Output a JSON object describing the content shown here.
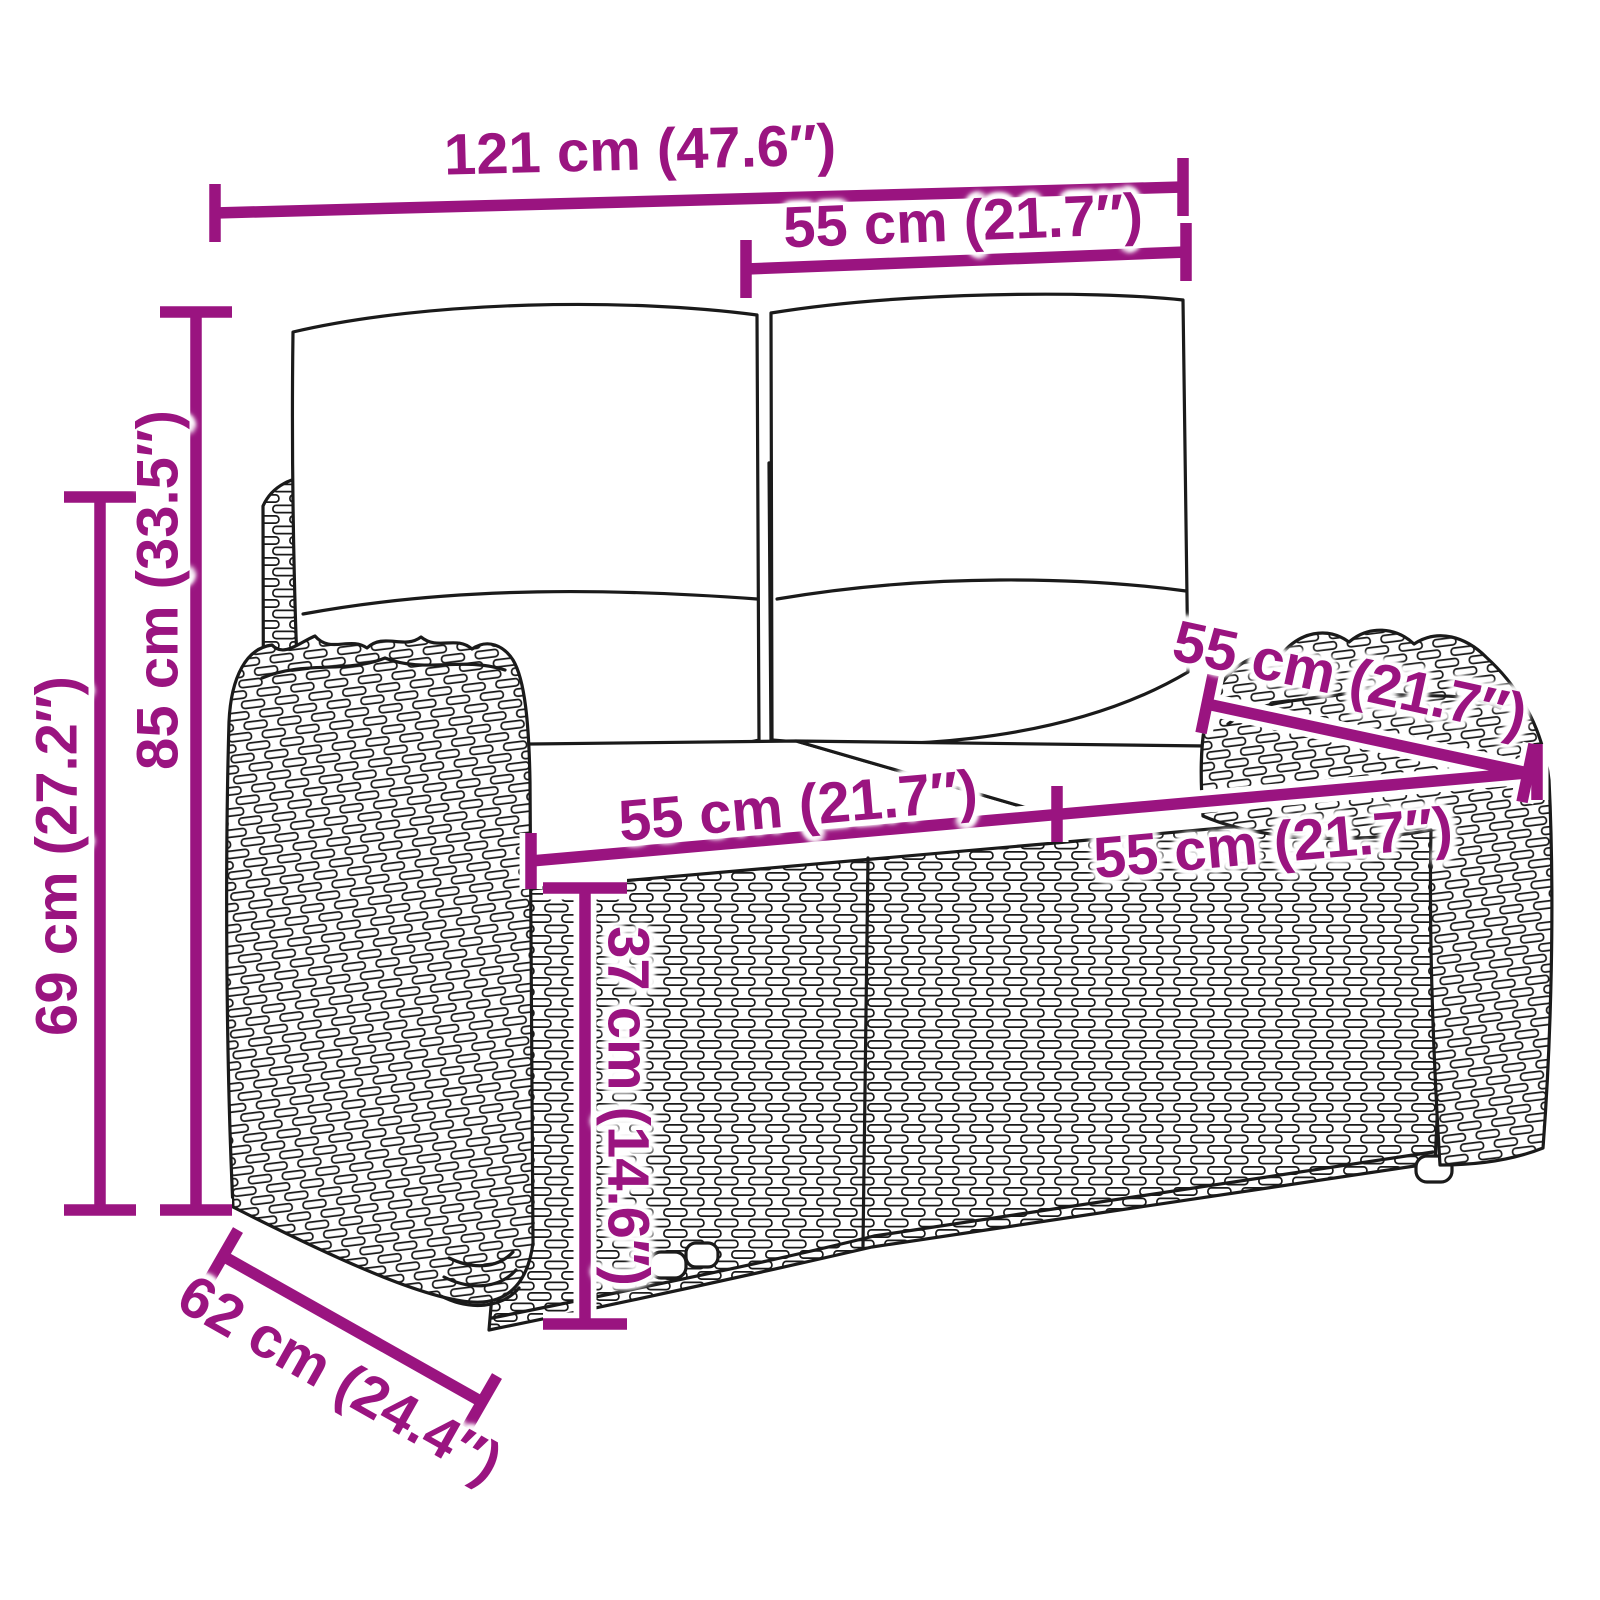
{
  "diagram": {
    "type": "product dimension diagram",
    "subject": "poly rattan 2-seater garden sofa with back and seat cushions"
  },
  "colors": {
    "dimension_annotation": "#9A1480",
    "line_art": "#1A1A1A",
    "background": "#FFFFFF"
  },
  "dimensions": {
    "overall_width": {
      "label": "121 cm (47.6″)",
      "cm": 121,
      "inches": 47.6
    },
    "backrest_width": {
      "label": "55 cm (21.7″)",
      "cm": 55,
      "inches": 21.7
    },
    "overall_height": {
      "label": "85 cm (33.5″)",
      "cm": 85,
      "inches": 33.5
    },
    "frame_height": {
      "label": "69 cm (27.2″)",
      "cm": 69,
      "inches": 27.2
    },
    "seat_width_left": {
      "label": "55 cm (21.7″)",
      "cm": 55,
      "inches": 21.7
    },
    "seat_width_right": {
      "label": "55 cm (21.7″)",
      "cm": 55,
      "inches": 21.7
    },
    "seat_depth": {
      "label": "55 cm (21.7″)",
      "cm": 55,
      "inches": 21.7
    },
    "seat_height": {
      "label": "37 cm (14.6″)",
      "cm": 37,
      "inches": 14.6
    },
    "overall_depth": {
      "label": "62 cm (24.4″)",
      "cm": 62,
      "inches": 24.4
    }
  }
}
